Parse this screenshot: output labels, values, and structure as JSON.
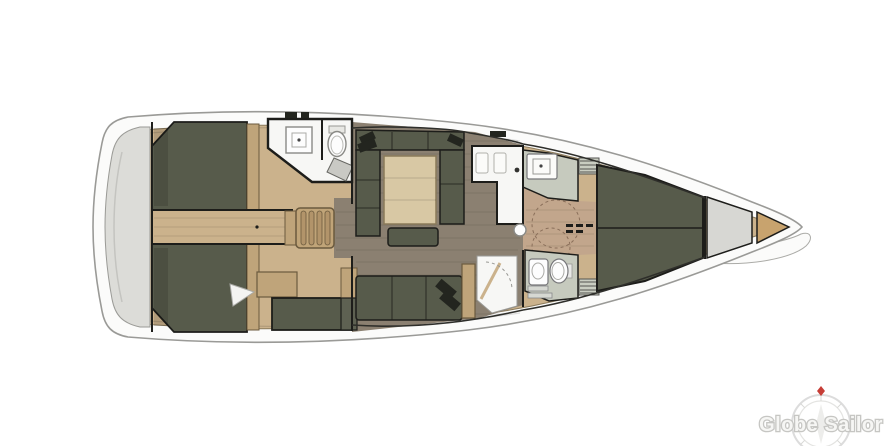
{
  "watermark": {
    "brand": "Globe Sailor"
  },
  "palette": {
    "background": "#ffffff",
    "hull_band": "#fbfbfa",
    "deck_wood": "#cbb28c",
    "platform": "#dcdcd8",
    "floor": "#8b8071",
    "forward_floor": "#c2a68c",
    "bed": "#575b4b",
    "bed_dark": "#23251f",
    "cabinet_dark": "#5e6152",
    "wood_light": "#d8c8a4",
    "wood_mid": "#bfa47a",
    "stair_wood": "#c0a478",
    "stair_ridge": "#b2946a",
    "locker_wood": "#c8a36e",
    "white_room": "#f7f7f5",
    "fixture": "#c6cabe",
    "steel": "#d7d7d3",
    "wall": "#1d1d1a",
    "logo_ring": "#dcdcdc",
    "logo_text": "#f6f6f4",
    "logo_accent": "#c63d36"
  }
}
